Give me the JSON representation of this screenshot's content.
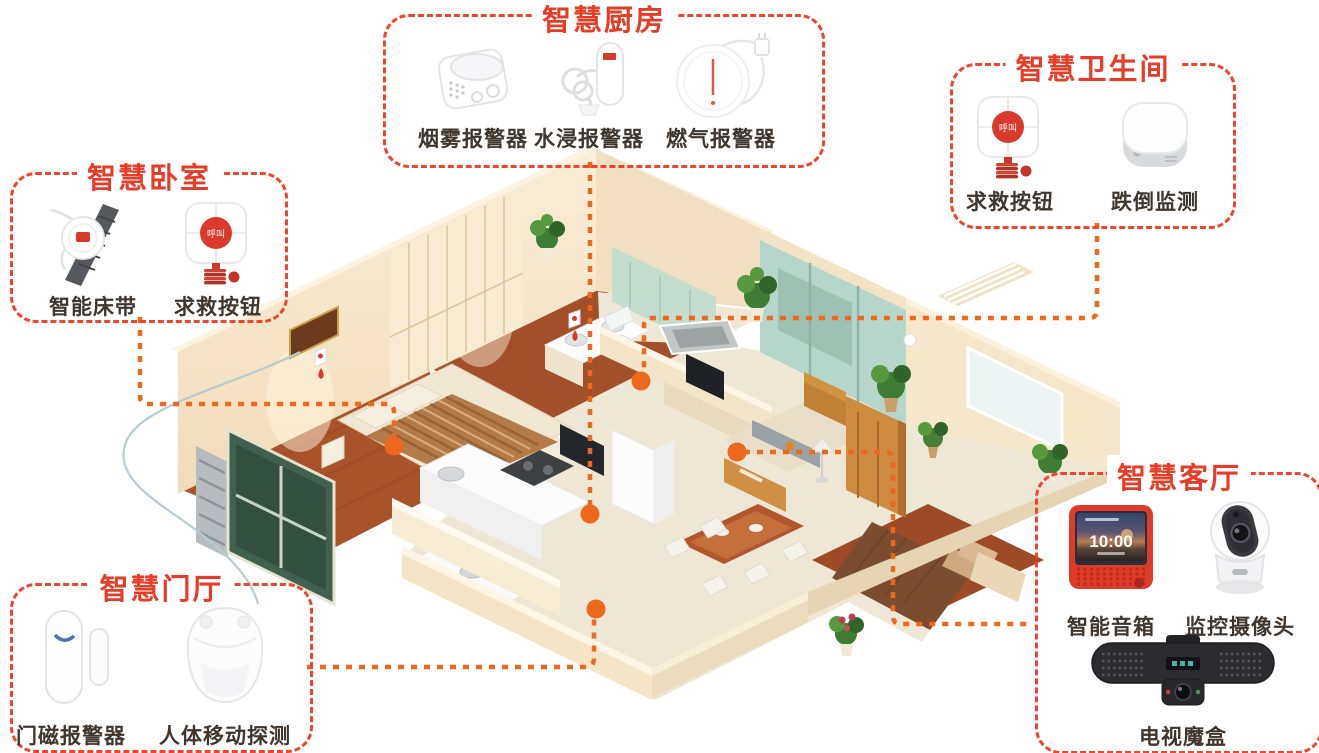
{
  "page": {
    "background": "#ffffff"
  },
  "palette": {
    "title_red": "#e73c27",
    "box_border_red": "#f2432c",
    "connector_orange": "#ed671c",
    "label_color": "#40362e",
    "device_button_red": "#d93a2b"
  },
  "groups": {
    "kitchen": {
      "title": "智慧厨房",
      "devices": [
        {
          "label": "烟雾报警器"
        },
        {
          "label": "水浸报警器"
        },
        {
          "label": "燃气报警器"
        }
      ]
    },
    "bathroom": {
      "title": "智慧卫生间",
      "devices": [
        {
          "label": "求救按钮",
          "button_text": "呼叫"
        },
        {
          "label": "跌倒监测"
        }
      ]
    },
    "bedroom": {
      "title": "智慧卧室",
      "devices": [
        {
          "label": "智能床带"
        },
        {
          "label": "求救按钮",
          "button_text": "呼叫"
        }
      ]
    },
    "entrance": {
      "title": "智慧门厅",
      "devices": [
        {
          "label": "门磁报警器"
        },
        {
          "label": "人体移动探测"
        }
      ]
    },
    "living": {
      "title": "智慧客厅",
      "devices": [
        {
          "label": "智能音箱",
          "screen_time": "10:00"
        },
        {
          "label": "监控摄像头"
        },
        {
          "label": "电视魔盒"
        }
      ]
    }
  }
}
